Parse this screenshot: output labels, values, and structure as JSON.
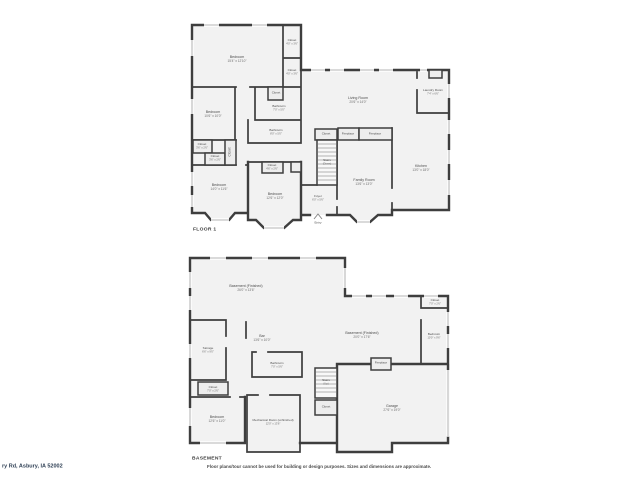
{
  "floor1": {
    "title": "FLOOR 1",
    "rooms": [
      {
        "name": "Bedroom",
        "dims": "15'4\" x 12'10\""
      },
      {
        "name": "Closet",
        "dims": "4'0\" x 3'6\""
      },
      {
        "name": "Closet",
        "dims": "4'0\" x 3'6\""
      },
      {
        "name": "Living Room",
        "dims": "20'6\" x 14'0\""
      },
      {
        "name": "Laundry Room",
        "dims": "7'4\" x 6'6\""
      },
      {
        "name": "Bedroom",
        "dims": "10'6\" x 10'0\""
      },
      {
        "name": "Closet",
        "dims": "3'0\" x 2'6\""
      },
      {
        "name": "Bathroom",
        "dims": "7'0\" x 5'0\""
      },
      {
        "name": "Bathroom",
        "dims": "8'0\" x 5'0\""
      },
      {
        "name": "Closet",
        "dims": "3'6\" x 2'6\""
      },
      {
        "name": "Closet",
        "dims": "3'6\" x 2'6\""
      },
      {
        "name": "Closet",
        "dims": ""
      },
      {
        "name": "Bedroom",
        "dims": "14'0\" x 11'6\""
      },
      {
        "name": "Closet",
        "dims": "4'6\" x 2'6\""
      },
      {
        "name": "Bedroom",
        "dims": "12'6\" x 12'0\""
      },
      {
        "name": "Foyer",
        "dims": "6'0\" x 5'6\""
      },
      {
        "name": "Stairs",
        "sub": "(Down)"
      },
      {
        "name": "Closet",
        "dims": "4'6\" x 2'0\""
      },
      {
        "name": "Fireplace"
      },
      {
        "name": "Fireplace"
      },
      {
        "name": "Family Room",
        "dims": "13'6\" x 13'0\""
      },
      {
        "name": "Kitchen",
        "dims": "13'0\" x 18'0\""
      },
      {
        "name": "Entry"
      }
    ]
  },
  "basement": {
    "title": "BASEMENT",
    "rooms": [
      {
        "name": "Basement (Finished)",
        "dims": "26'0\" x 13'6\""
      },
      {
        "name": "Bar",
        "dims": "13'6\" x 10'0\""
      },
      {
        "name": "Basement (Finished)",
        "dims": "20'0\" x 17'6\""
      },
      {
        "name": "Closet",
        "dims": "7'0\" x 2'6\""
      },
      {
        "name": "Bedroom",
        "dims": "10'0\" x 9'6\""
      },
      {
        "name": "Storage",
        "dims": "6'6\" x 9'0\""
      },
      {
        "name": "Bathroom",
        "dims": "7'0\" x 5'6\""
      },
      {
        "name": "Closet",
        "dims": "7'0\" x 2'6\""
      },
      {
        "name": "Bedroom",
        "dims": "12'6\" x 11'0\""
      },
      {
        "name": "Mechanical Room (unfinished)",
        "dims": "12'0\" x 13'6\""
      },
      {
        "name": "Stairs",
        "sub": "(Up)"
      },
      {
        "name": "Closet"
      },
      {
        "name": "Fireplace"
      },
      {
        "name": "Garage",
        "dims": "27'6\" x 19'0\""
      }
    ]
  },
  "footer": {
    "address": "ry Rd, Asbury, IA 52002",
    "disclaimer": "Floor plans/tour cannot be used for building or design purposes. Sizes and dimensions are approximate."
  },
  "colors": {
    "wall": "#3e3e3e",
    "room_fill": "#f2f2f2",
    "window": "#c4c4c4",
    "label": "#4d4d4d"
  }
}
